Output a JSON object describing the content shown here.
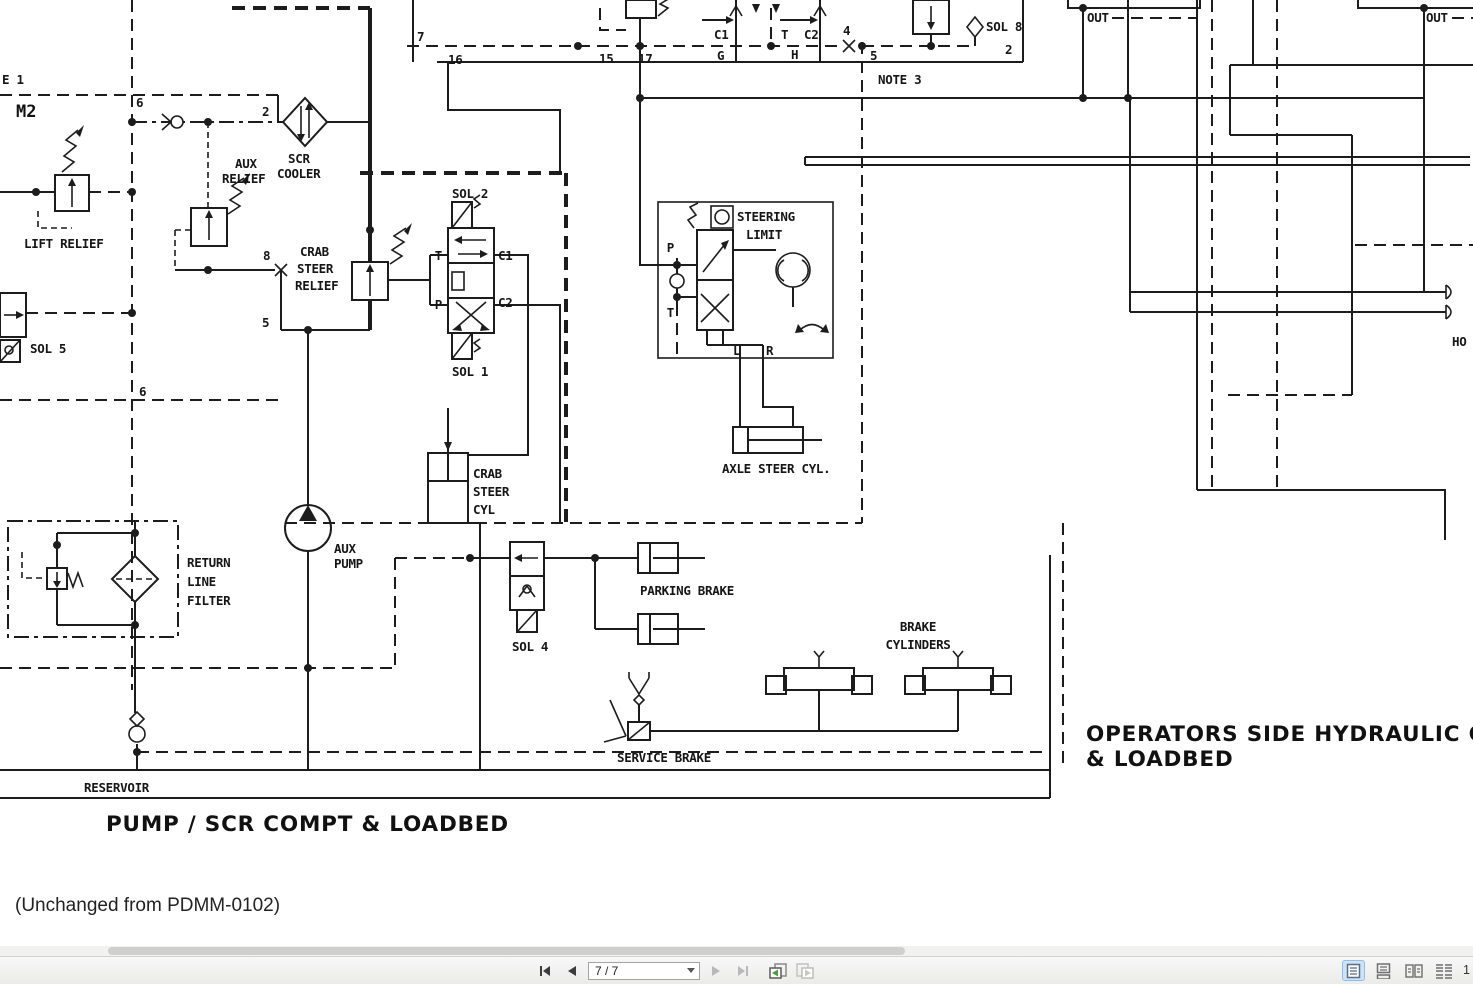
{
  "diagram": {
    "captions": {
      "pump_compt": "PUMP / SCR COMPT & LOADBED",
      "operators_side_1": "OPERATORS SIDE HYDRAULIC C",
      "operators_side_2": "& LOADBED",
      "footnote": "(Unchanged from PDMM-0102)"
    },
    "labels": {
      "e1": "E 1",
      "m2": "M2",
      "scr_cooler": [
        "SCR",
        "COOLER"
      ],
      "aux_relief": [
        "AUX",
        "RELIEF"
      ],
      "lift_relief": "LIFT RELIEF",
      "sol_5": "SOL 5",
      "crab_steer_relief": [
        "CRAB",
        "STEER",
        "RELIEF"
      ],
      "sol_2": "SOL 2",
      "sol_1": "SOL 1",
      "sol_4": "SOL 4",
      "sol_8": "SOL 8",
      "steering_limit": [
        "STEERING",
        "LIMIT"
      ],
      "axle_steer_cyl": "AXLE STEER CYL.",
      "crab_steer_cyl": [
        "CRAB",
        "STEER",
        "CYL"
      ],
      "return_line_filter": [
        "RETURN",
        "LINE",
        "FILTER"
      ],
      "aux_pump": [
        "AUX",
        "PUMP"
      ],
      "parking_brake": "PARKING BRAKE",
      "brake_cylinders": [
        "BRAKE",
        "CYLINDERS"
      ],
      "service_brake": "SERVICE BRAKE",
      "reservoir": "RESERVOIR",
      "note_3": "NOTE 3",
      "out": "OUT",
      "hose_stub": "HO"
    },
    "ports": {
      "c1": "C1",
      "c2": "C2",
      "t": "T",
      "p": "P",
      "g": "G",
      "h": "H",
      "l": "L",
      "r": "R"
    },
    "refs": {
      "n2": "2",
      "n4": "4",
      "n5": "5",
      "n6": "6",
      "n7": "7",
      "n8": "8",
      "n15": "15",
      "n16": "16",
      "n17": "17"
    }
  },
  "viewer": {
    "toolbar": {
      "page_display": "7 / 7",
      "zoom_fragment": "1",
      "icons": {
        "first_page": "first-page",
        "prev_page": "previous-page",
        "next_page": "next-page",
        "last_page": "last-page",
        "prev_view": "previous-view",
        "next_view": "next-view"
      },
      "view_modes": [
        "single-page",
        "continuous",
        "two-page",
        "two-page-continuous"
      ]
    }
  }
}
